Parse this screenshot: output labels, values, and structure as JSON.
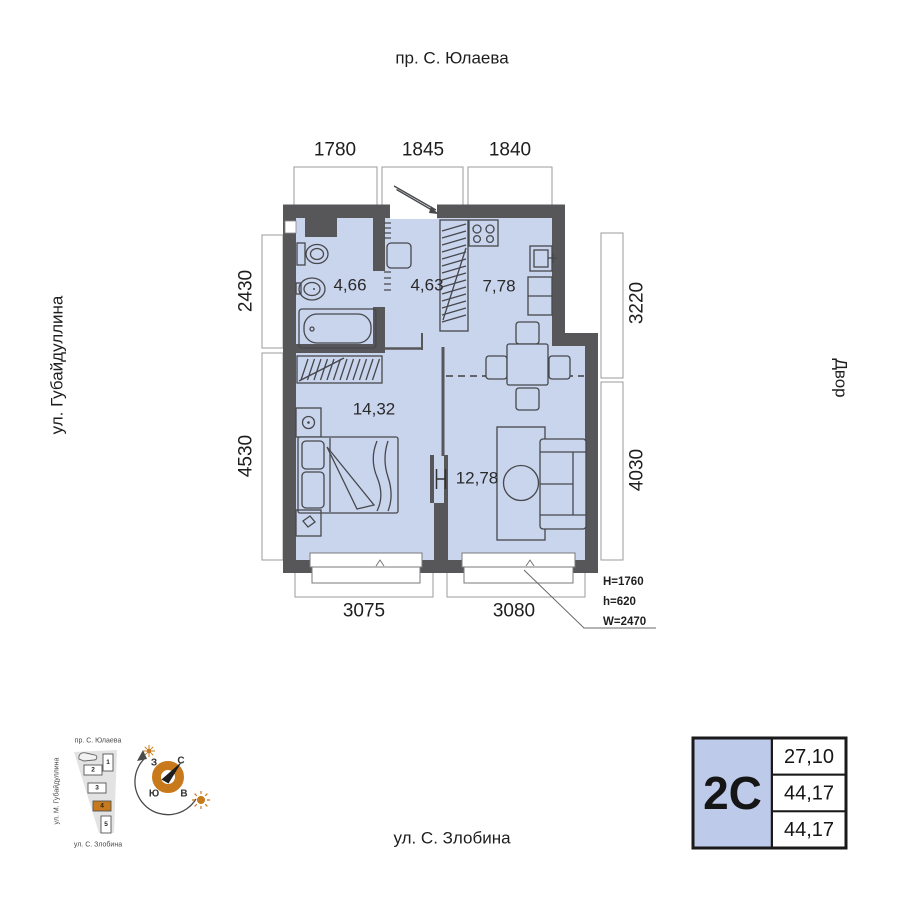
{
  "streets": {
    "top": "пр. С. Юлаева",
    "left": "ул. Губайдуллина",
    "right": "Двор",
    "bottom": "ул. С. Злобина"
  },
  "dims": {
    "top": [
      "1780",
      "1845",
      "1840"
    ],
    "left": [
      "2430",
      "4530"
    ],
    "right": [
      "3220",
      "4030"
    ],
    "bottom": [
      "3075",
      "3080"
    ]
  },
  "areas": {
    "bathroom": "4,66",
    "hallway": "4,63",
    "kitchen": "7,78",
    "bedroom": "14,32",
    "living": "12,78"
  },
  "window_spec": [
    "H=1760",
    "h=620",
    "W=2470"
  ],
  "info_table": {
    "type": "2С",
    "rows": [
      "27,10",
      "44,17",
      "44,17"
    ]
  },
  "site_plan": {
    "top_street": "пр. С. Юлаева",
    "left_street": "ул. М. Губайдуллина",
    "bottom_street": "ул. С. Злобина",
    "blocks": [
      "1",
      "2",
      "3",
      "4",
      "5"
    ],
    "highlighted_block": "4"
  },
  "compass": {
    "north": "С",
    "south": "Ю",
    "west": "З",
    "east": "В"
  },
  "colors": {
    "wall": "#57575A",
    "room_fill": "#C9D4ED",
    "accent_orange": "#C8791B",
    "type_cell_fill": "#BDCAE9"
  }
}
